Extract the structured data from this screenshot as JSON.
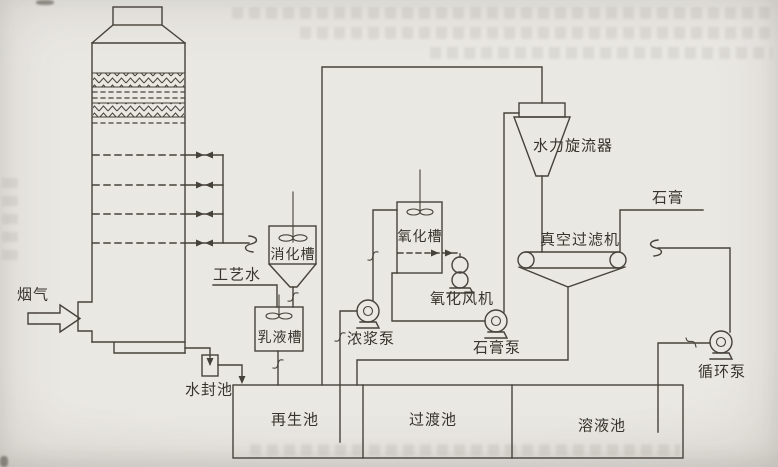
{
  "diagram": {
    "description_labels": {
      "flue_gas": "烟气",
      "water_seal_pool": "水封池",
      "process_water": "工艺水",
      "digestion_tank": "消化槽",
      "emulsion_tank": "乳液槽",
      "slurry_pump": "浓浆泵",
      "oxidation_tank": "氧化槽",
      "oxidation_fan": "氧化风机",
      "gypsum_pump": "石膏泵",
      "hydrocyclone": "水力旋流器",
      "vacuum_filter": "真空过滤机",
      "gypsum_product": "石膏",
      "circulation_pump": "循环泵",
      "regeneration_pool": "再生池",
      "transition_pool": "过渡池",
      "solution_pool": "溶液池"
    },
    "colors": {
      "line": "#46423b",
      "paper": "#e9e7e2",
      "text": "#38342e"
    }
  }
}
